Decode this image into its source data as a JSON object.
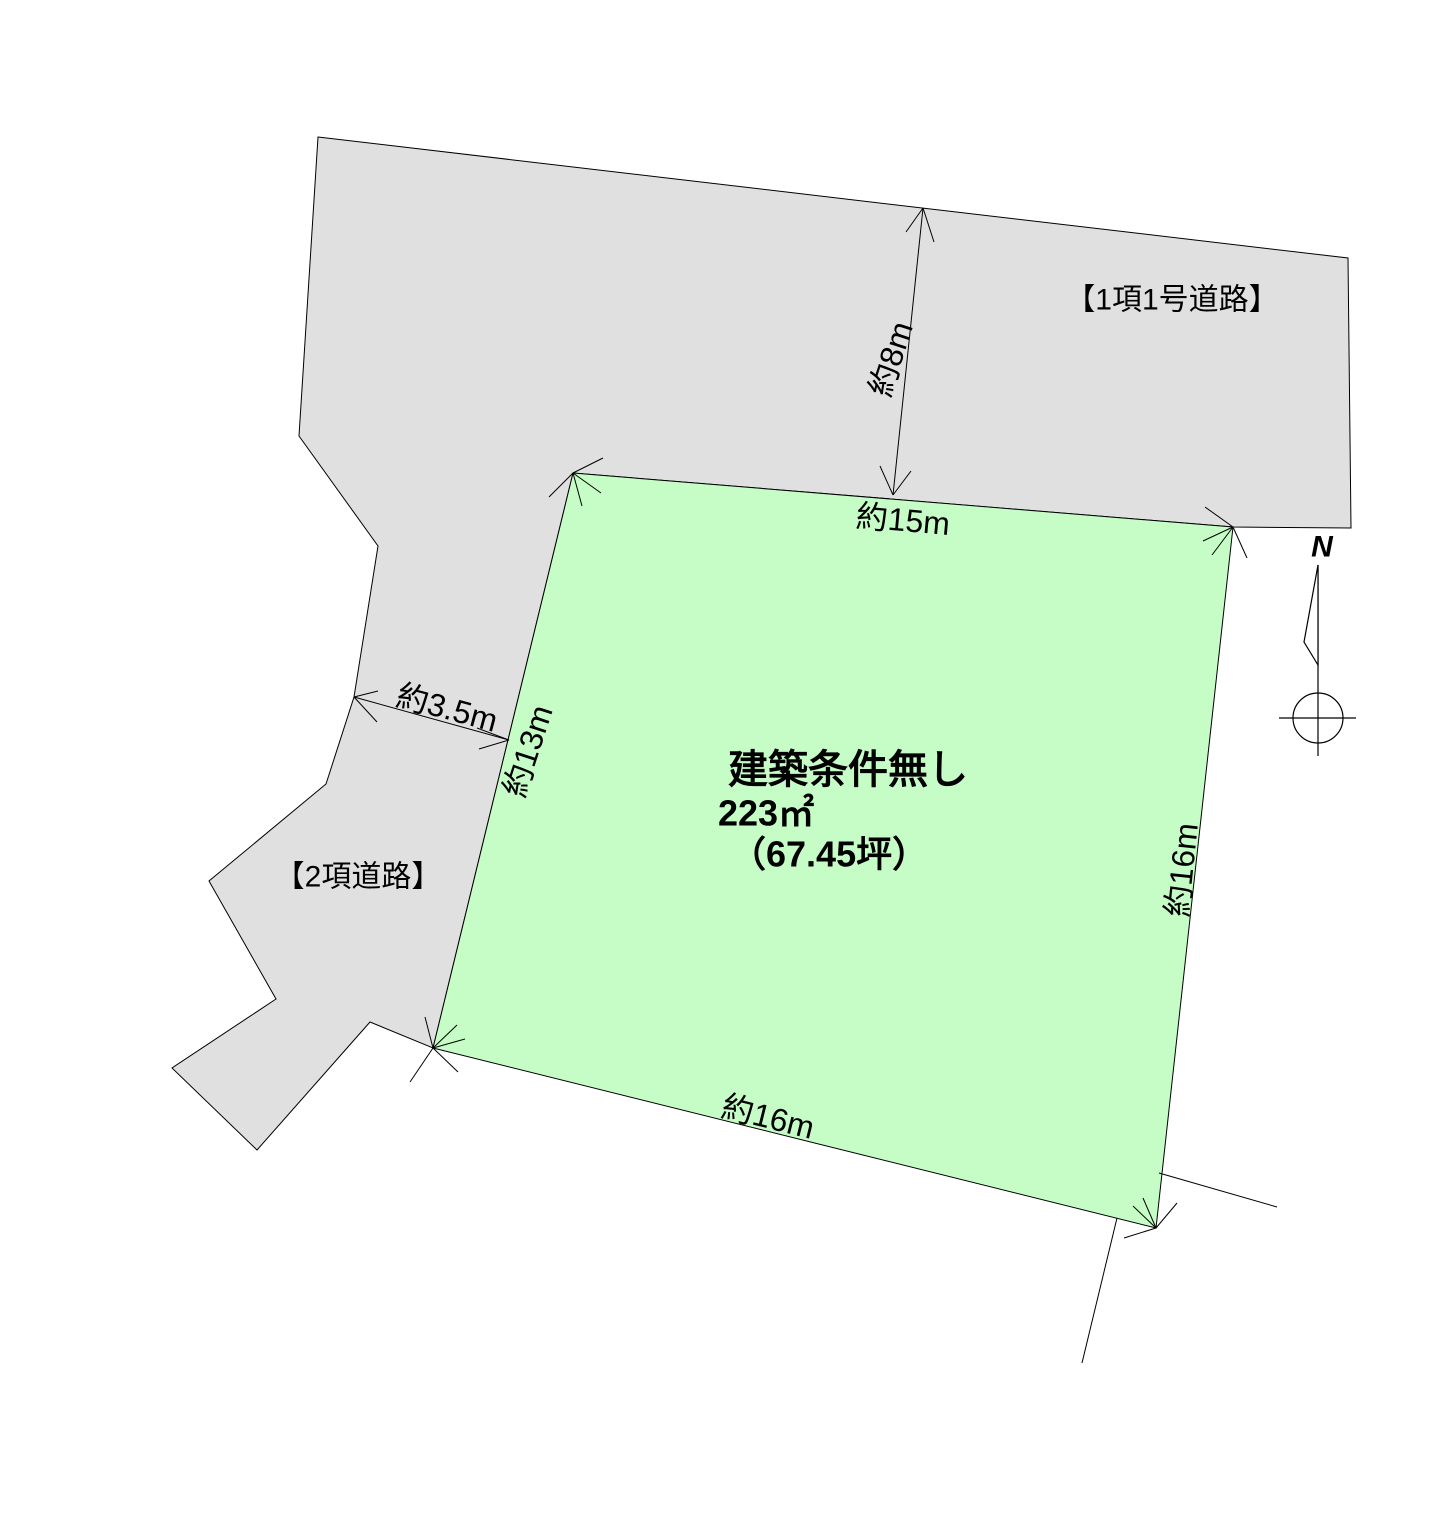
{
  "diagram": {
    "width": 1438,
    "height": 1524,
    "colors": {
      "background": "#ffffff",
      "road_fill": "#e0e0e0",
      "lot_fill": "#c6fdc6",
      "line": "#000000"
    },
    "road_polygon": [
      [
        318,
        137
      ],
      [
        1348,
        258
      ],
      [
        1351,
        528
      ],
      [
        1233,
        527
      ],
      [
        573,
        473
      ],
      [
        433,
        1048
      ],
      [
        370,
        1022
      ],
      [
        257,
        1150
      ],
      [
        172,
        1068
      ],
      [
        276,
        999
      ],
      [
        209,
        881
      ],
      [
        326,
        784
      ],
      [
        354,
        697
      ],
      [
        378,
        546
      ],
      [
        299,
        436
      ]
    ],
    "lot_polygon": [
      [
        573,
        473
      ],
      [
        1233,
        527
      ],
      [
        1156,
        1228
      ],
      [
        433,
        1048
      ]
    ],
    "dimension_lines": [
      {
        "name": "dim-line-8m",
        "x1": 923,
        "y1": 208,
        "x2": 893,
        "y2": 495
      },
      {
        "name": "dim-line-3-5m",
        "x1": 354,
        "y1": 697,
        "x2": 509,
        "y2": 740
      }
    ],
    "arrow_ticks": [
      [
        573,
        473,
        603,
        458
      ],
      [
        573,
        473,
        549,
        497
      ],
      [
        573,
        473,
        582,
        506
      ],
      [
        573,
        473,
        601,
        493
      ],
      [
        1233,
        527,
        1205,
        507
      ],
      [
        1233,
        527,
        1203,
        541
      ],
      [
        1233,
        527,
        1212,
        555
      ],
      [
        1233,
        527,
        1247,
        558
      ],
      [
        433,
        1048,
        425,
        1017
      ],
      [
        433,
        1048,
        457,
        1025
      ],
      [
        433,
        1048,
        465,
        1039
      ],
      [
        433,
        1048,
        458,
        1072
      ],
      [
        433,
        1048,
        410,
        1082
      ],
      [
        1156,
        1228,
        1133,
        1206
      ],
      [
        1156,
        1228,
        1143,
        1198
      ],
      [
        1156,
        1228,
        1177,
        1203
      ],
      [
        1156,
        1228,
        1124,
        1238
      ],
      [
        923,
        208,
        906,
        232
      ],
      [
        923,
        208,
        934,
        242
      ],
      [
        893,
        495,
        880,
        466
      ],
      [
        893,
        495,
        911,
        471
      ],
      [
        354,
        697,
        378,
        691
      ],
      [
        354,
        697,
        377,
        722
      ],
      [
        509,
        740,
        479,
        749
      ],
      [
        509,
        740,
        477,
        728
      ]
    ],
    "neighbor_lines": [
      [
        1159,
        1173,
        1277,
        1207
      ],
      [
        1117,
        1218,
        1082,
        1363
      ]
    ],
    "compass": {
      "label": "N",
      "label_x": 1322,
      "label_y": 547,
      "staff": [
        1318,
        565,
        1318,
        756
      ],
      "pennant": [
        [
          1318,
          565
        ],
        [
          1304,
          642
        ],
        [
          1318,
          665
        ]
      ],
      "circle": {
        "cx": 1318,
        "cy": 718,
        "r": 25
      },
      "crosshair": [
        1279,
        718,
        1356,
        718
      ]
    },
    "labels": [
      {
        "name": "road1-label",
        "text": "【1項1号道路】",
        "x": 1172,
        "y": 300,
        "rot": 0,
        "size": 30,
        "weight": "normal",
        "anchor": "middle",
        "italic": false
      },
      {
        "name": "road2-label",
        "text": "【2項道路】",
        "x": 358,
        "y": 877,
        "rot": 0,
        "size": 30,
        "weight": "normal",
        "anchor": "middle",
        "italic": false
      },
      {
        "name": "dim-8m-label",
        "text": "約8m",
        "x": 891,
        "y": 359,
        "rot": -72,
        "size": 32,
        "weight": "normal",
        "anchor": "middle",
        "italic": false
      },
      {
        "name": "dim-15m-label",
        "text": "約15m",
        "x": 903,
        "y": 520,
        "rot": 5,
        "size": 32,
        "weight": "normal",
        "anchor": "middle",
        "italic": false
      },
      {
        "name": "dim-3-5m-label",
        "text": "約3.5m",
        "x": 447,
        "y": 708,
        "rot": 15,
        "size": 32,
        "weight": "normal",
        "anchor": "middle",
        "italic": false
      },
      {
        "name": "dim-13m-label",
        "text": "約13m",
        "x": 528,
        "y": 751,
        "rot": -72,
        "size": 32,
        "weight": "normal",
        "anchor": "middle",
        "italic": false
      },
      {
        "name": "dim-16m-east-label",
        "text": "約16m",
        "x": 1182,
        "y": 870,
        "rot": -84,
        "size": 32,
        "weight": "normal",
        "anchor": "middle",
        "italic": false
      },
      {
        "name": "dim-16m-south-label",
        "text": "約16m",
        "x": 768,
        "y": 1117,
        "rot": 14,
        "size": 32,
        "weight": "normal",
        "anchor": "middle",
        "italic": false
      },
      {
        "name": "lot-title",
        "text": "建築条件無し",
        "x": 848,
        "y": 770,
        "rot": 0,
        "size": 40,
        "weight": "bold",
        "anchor": "middle",
        "italic": false
      },
      {
        "name": "lot-area",
        "text": "223㎡",
        "x": 718,
        "y": 813,
        "rot": 0,
        "size": 36,
        "weight": "bold",
        "anchor": "start",
        "italic": false
      },
      {
        "name": "lot-tsubo",
        "text": "（67.45坪）",
        "x": 730,
        "y": 854,
        "rot": 0,
        "size": 36,
        "weight": "bold",
        "anchor": "start",
        "italic": false
      },
      {
        "name": "north-label",
        "text": "N",
        "x": 1322,
        "y": 547,
        "rot": 0,
        "size": 30,
        "weight": "bold",
        "anchor": "middle",
        "italic": true
      }
    ]
  }
}
